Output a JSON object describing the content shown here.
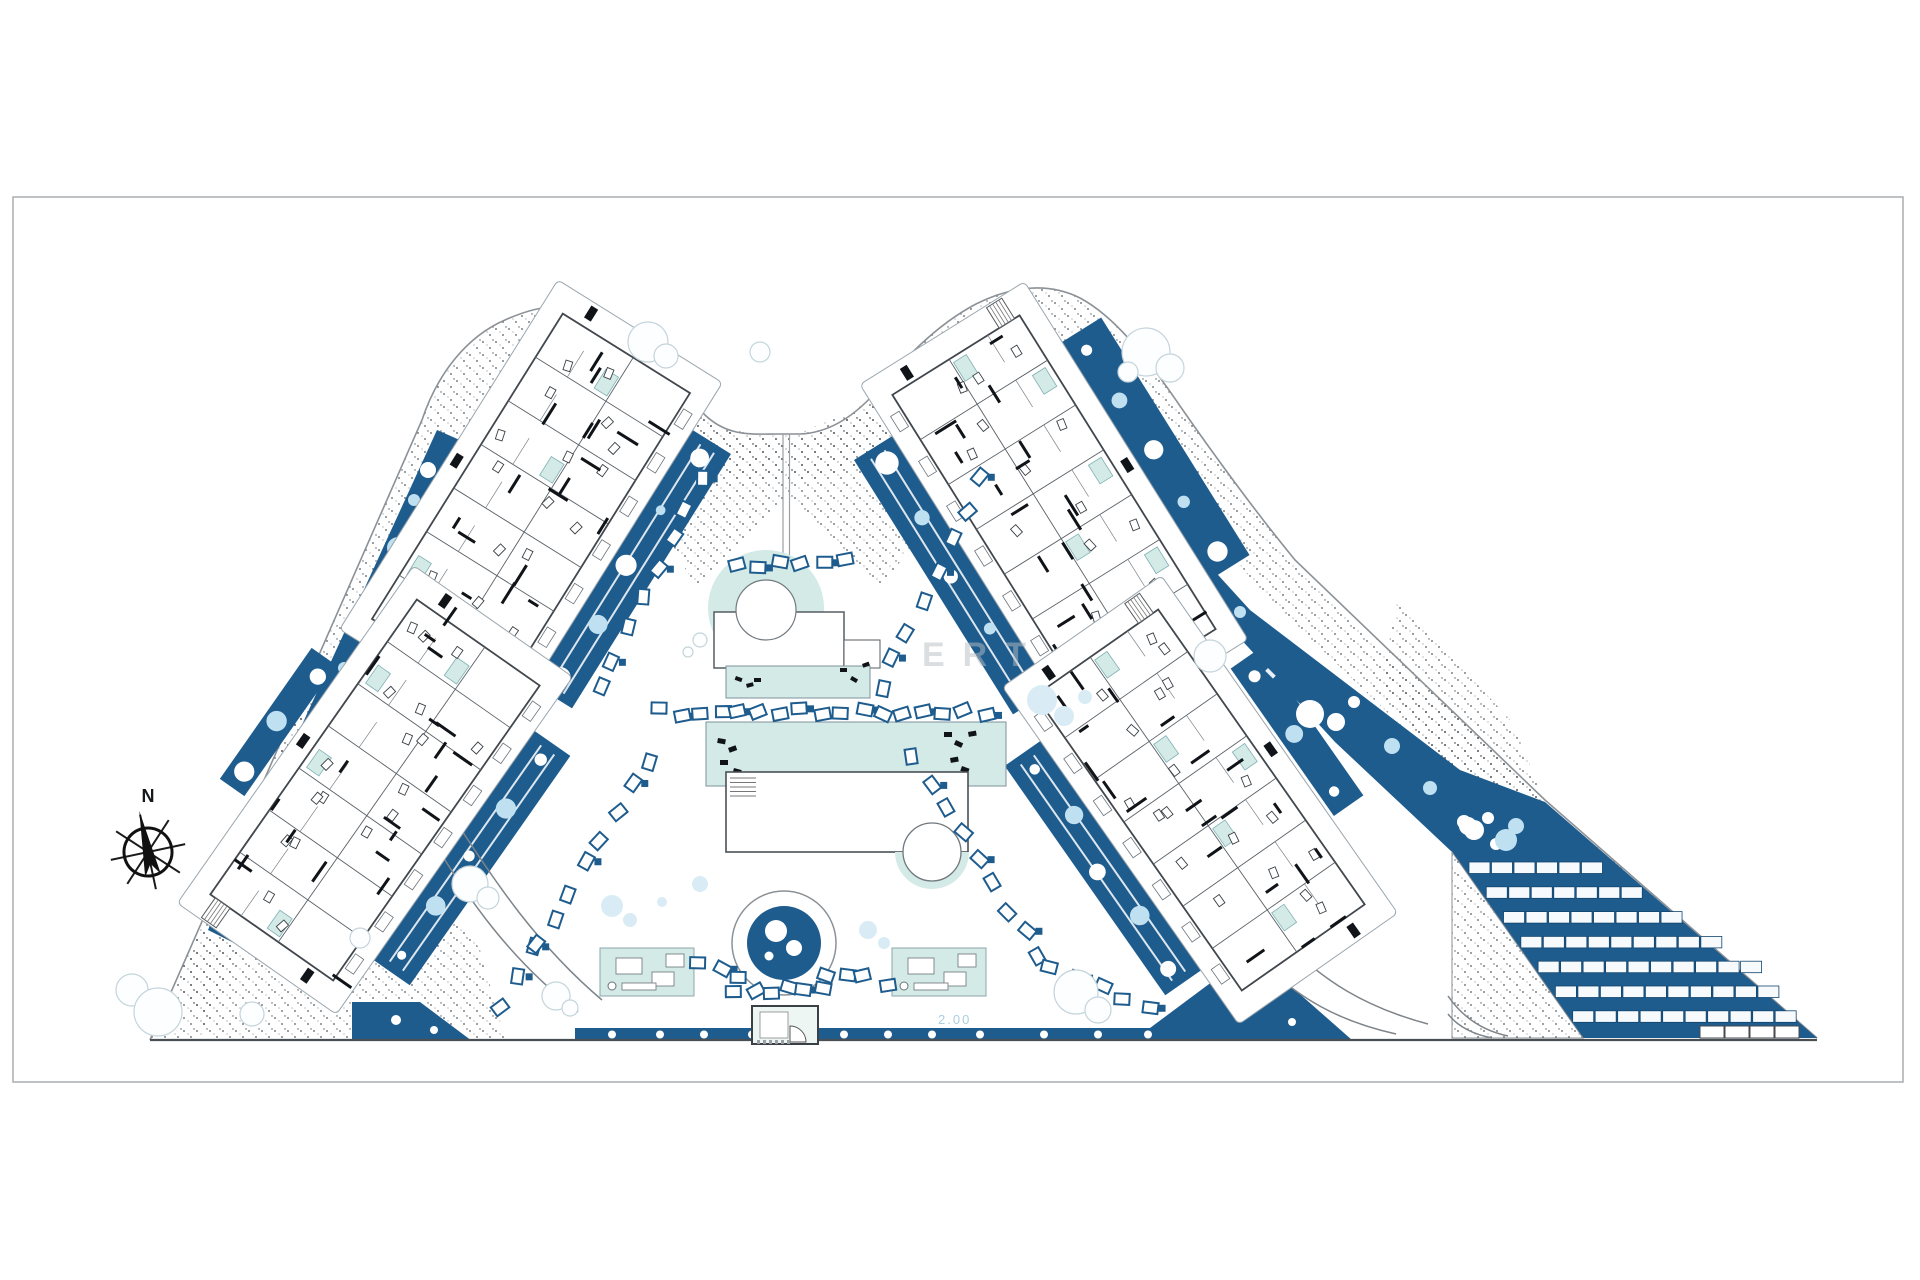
{
  "page": {
    "background": "#ffffff",
    "border_color": "#a9adb1"
  },
  "colors": {
    "navy": "#1e5c8e",
    "pool": "#d3eae6",
    "pale_circle": "#bfe0f0",
    "stipple": "#3a3f44",
    "line": "#8b9196",
    "canal_text": "#a9cfe0",
    "watermark": "#b9bec2"
  },
  "compass": {
    "label": "N"
  },
  "annotations": {
    "depth_marker": "2.00",
    "watermark_text": "ERT"
  },
  "site": {
    "parking": {
      "rows": [
        6,
        7,
        8,
        9,
        10,
        10,
        10
      ],
      "base_row_stalls": 4
    }
  }
}
